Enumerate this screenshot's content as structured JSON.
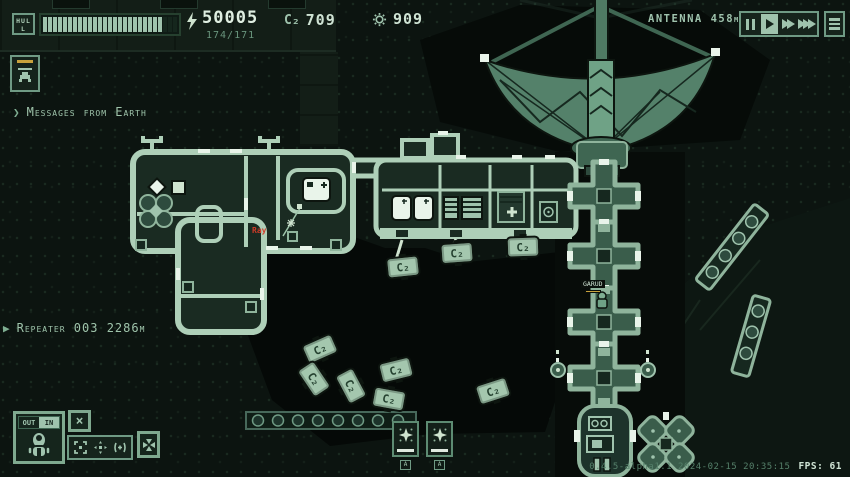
{
  "hud": {
    "hull": {
      "label": "HULL",
      "total": 27,
      "filled": 24
    },
    "energy": {
      "value": "50005",
      "secondary": "174/171"
    },
    "c2": {
      "label": "C₂",
      "value": "709"
    },
    "solar": {
      "value": "909"
    },
    "antenna_label": "ANTENNA 458m",
    "speed": {
      "active": "play"
    }
  },
  "left_panel": {
    "messages_label": "Messages from Earth",
    "repeater_label": "Repeater 003 2286m"
  },
  "view_controls": {
    "out_label": "OUT",
    "in_label": "IN",
    "active": "IN"
  },
  "map": {
    "tank_label": "C₂",
    "tanks": [
      {
        "x": 386,
        "y": 256,
        "rot": -6
      },
      {
        "x": 440,
        "y": 242,
        "rot": -4
      },
      {
        "x": 506,
        "y": 236,
        "rot": -2
      },
      {
        "x": 303,
        "y": 338,
        "rot": -24
      },
      {
        "x": 297,
        "y": 368,
        "rot": 56
      },
      {
        "x": 334,
        "y": 375,
        "rot": 62
      },
      {
        "x": 379,
        "y": 359,
        "rot": -14
      },
      {
        "x": 372,
        "y": 388,
        "rot": 10
      },
      {
        "x": 476,
        "y": 380,
        "rot": -18
      }
    ],
    "red_label": "Ray",
    "worker_name": "GARUD",
    "build_cards": [
      {
        "hotkey": "A"
      },
      {
        "hotkey": "A"
      }
    ]
  },
  "footer": {
    "version": "0.4.5-alpha1.1 2024-02-15 20:35:15",
    "fps_label": "FPS: 61"
  },
  "colors": {
    "accent_pale": "#aecfb8",
    "accent_mid": "#5d8b72",
    "bg": "#0c1410",
    "yellow": "#c8a23c",
    "red": "#cc3b2a"
  }
}
